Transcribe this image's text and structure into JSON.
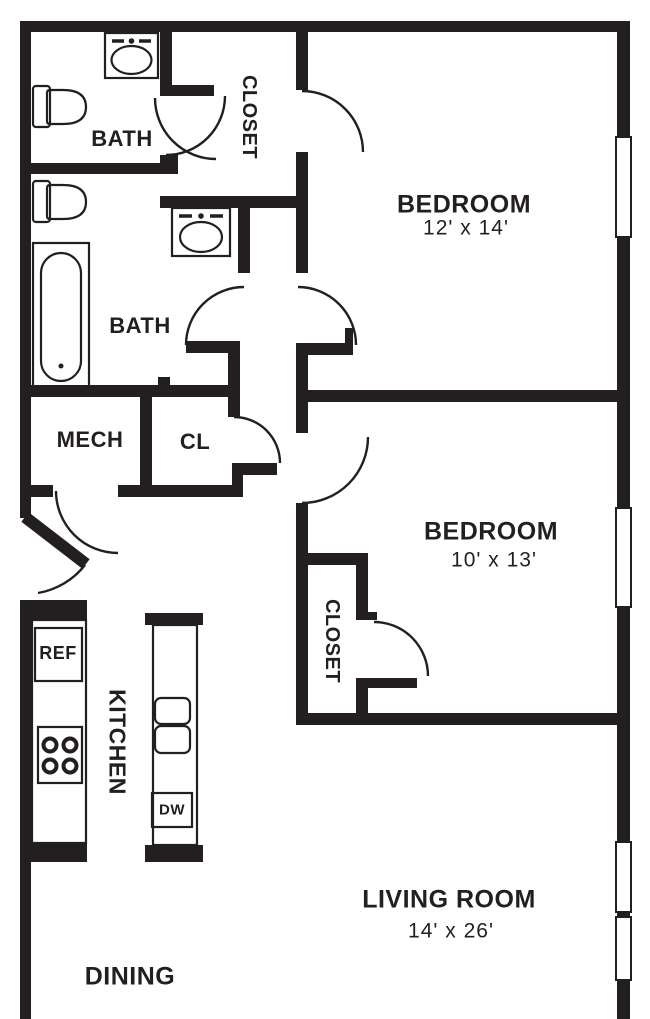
{
  "floor_plan": {
    "rooms": {
      "bath_upper": {
        "label": "BATH"
      },
      "closet_upper": {
        "label": "CLOSET"
      },
      "bedroom_1": {
        "label": "BEDROOM",
        "dimensions": "12' x 14'"
      },
      "bath_lower": {
        "label": "BATH"
      },
      "mech": {
        "label": "MECH"
      },
      "cl": {
        "label": "CL"
      },
      "bedroom_2": {
        "label": "BEDROOM",
        "dimensions": "10' x 13'"
      },
      "closet_bedroom_2": {
        "label": "CLOSET"
      },
      "kitchen": {
        "label": "KITCHEN"
      },
      "dining": {
        "label": "DINING"
      },
      "living_room": {
        "label": "LIVING ROOM",
        "dimensions": "14' x 26'"
      }
    },
    "appliances": {
      "refrigerator": {
        "label": "REF"
      },
      "dishwasher": {
        "label": "DW"
      }
    },
    "colors": {
      "wall": "#231f20",
      "background": "#ffffff"
    }
  }
}
